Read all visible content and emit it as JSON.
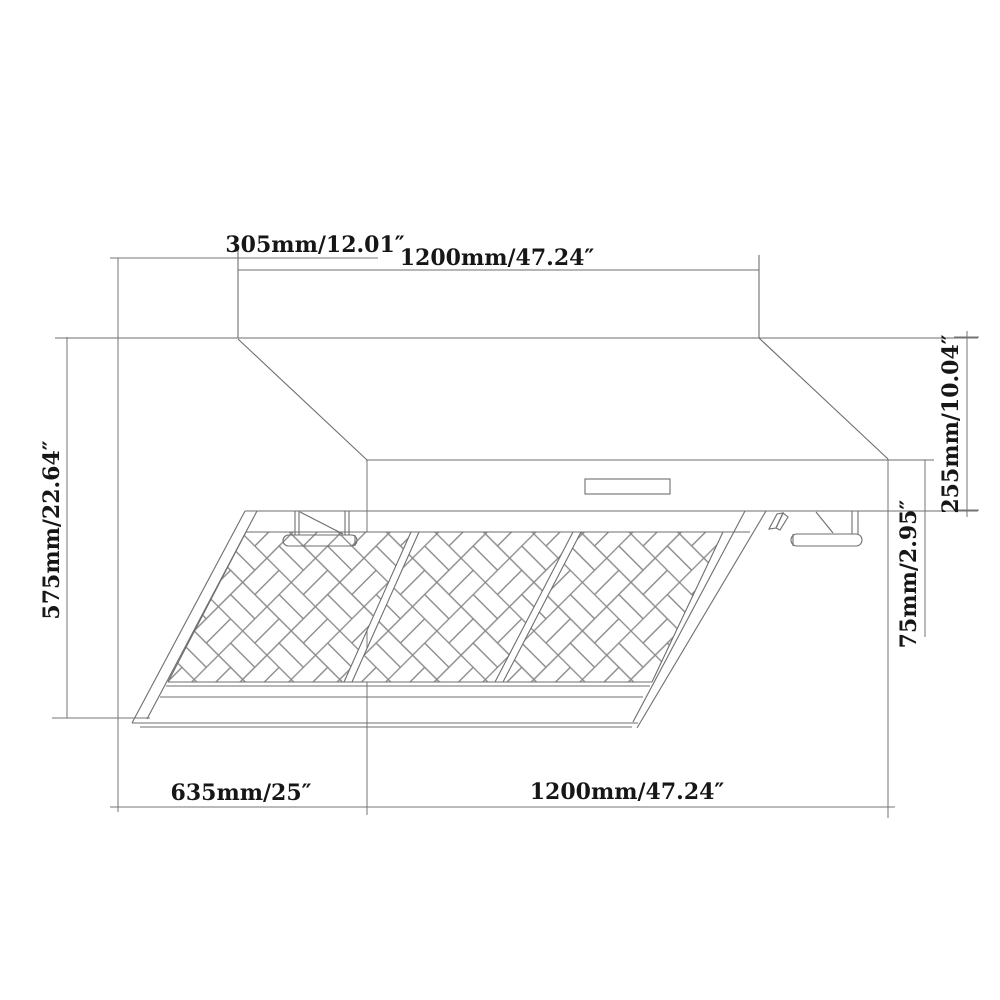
{
  "drawing": {
    "type": "range-hood-dimension-diagram",
    "background_color": "#ffffff",
    "line_color": "#757575",
    "text_color": "#161616",
    "dimensions": {
      "top_chimney_depth": "305mm/12.01″",
      "top_chimney_width": "1200mm/47.24″",
      "left_total_height": "575mm/22.64″",
      "right_body_height": "255mm/10.04″",
      "right_front_lip_height": "75mm/2.95″",
      "bottom_hood_depth": "635mm/25″",
      "bottom_hood_width": "1200mm/47.24″"
    },
    "values": {
      "top_chimney_depth_mm": 305,
      "top_chimney_width_mm": 1200,
      "left_total_height_mm": 575,
      "right_body_height_mm": 255,
      "right_front_lip_height_mm": 75,
      "bottom_hood_depth_mm": 635,
      "bottom_hood_width_mm": 1200
    }
  }
}
